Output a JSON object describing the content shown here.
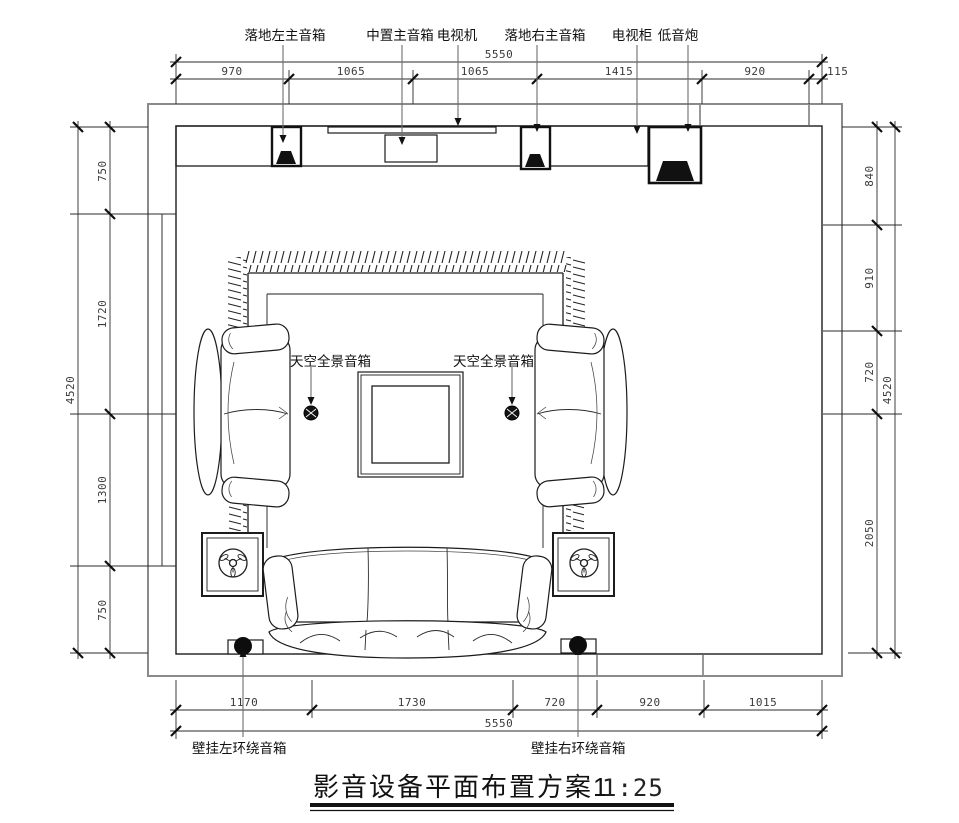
{
  "drawing_title": {
    "text": "影音设备平面布置方案1",
    "scale": "1:25"
  },
  "equipment_labels": {
    "floor_left_main": "落地左主音箱",
    "center_main": "中置主音箱",
    "tv": "电视机",
    "floor_right_main": "落地右主音箱",
    "tv_cabinet": "电视柜",
    "subwoofer": "低音炮",
    "sky_left": "天空全景音箱",
    "sky_right": "天空全景音箱",
    "wall_surround_left": "壁挂左环绕音箱",
    "wall_surround_right": "壁挂右环绕音箱"
  },
  "dimensions": {
    "top": {
      "total": "5550",
      "segments": [
        "970",
        "1065",
        "1065",
        "1415",
        "920",
        "115"
      ]
    },
    "bottom": {
      "total": "5550",
      "segments": [
        "1170",
        "1730",
        "720",
        "920",
        "1015"
      ]
    },
    "left": {
      "total": "4520",
      "segments": [
        "750",
        "1720",
        "1300",
        "750"
      ]
    },
    "right": {
      "total": "4520",
      "segments": [
        "840",
        "910",
        "720",
        "2050"
      ]
    }
  },
  "colors": {
    "line": "#1c1c1c",
    "wall_outer": "#8a8a8a",
    "leader": "#6e6e6e",
    "dim_text": "#3a3a3a"
  }
}
